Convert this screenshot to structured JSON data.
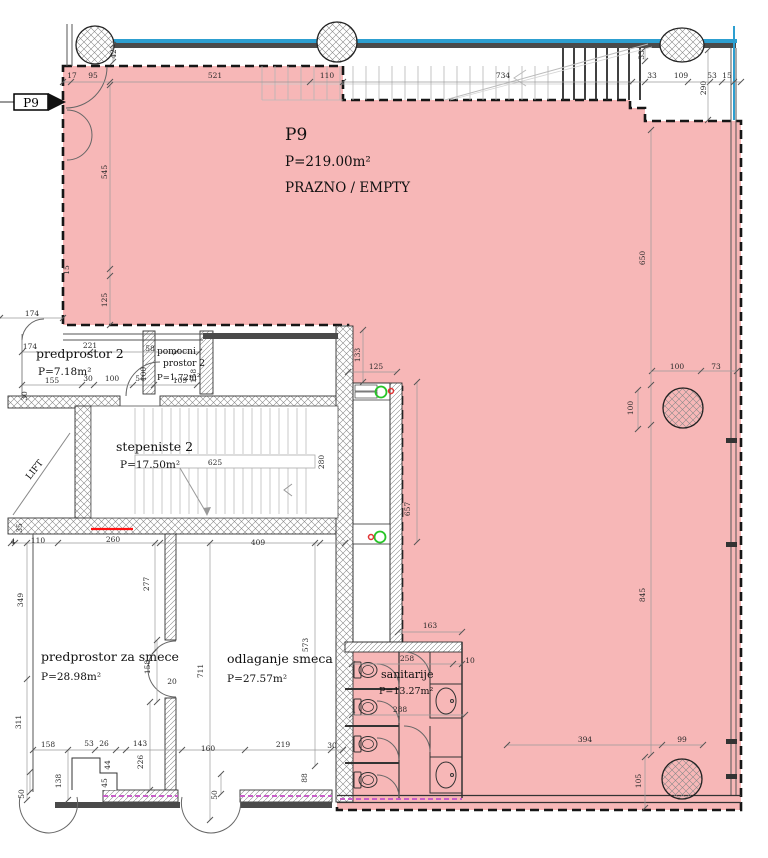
{
  "drawing": {
    "unit_tag": "P9",
    "main_space": {
      "name": "P9",
      "area": "P=219.00m²",
      "status": "PRAZNO / EMPTY"
    },
    "rooms": {
      "predprostor2": {
        "name": "predprostor 2",
        "area": "P=7.18m²"
      },
      "pomocni_prostor2": {
        "name_l1": "pomocni",
        "name_l2": "prostor 2",
        "area": "P=1.72m²"
      },
      "stepeniste2": {
        "name": "stepeniste 2",
        "area": "P=17.50m²"
      },
      "lift": {
        "name": "LIFT"
      },
      "predprostor_za_smece": {
        "name": "predprostor za smece",
        "area": "P=28.98m²"
      },
      "odlaganje_smeca": {
        "name": "odlaganje smeca",
        "area": "P=27.57m²"
      },
      "sanitarije": {
        "name": "sanitarije",
        "area": "P=13.27m²"
      }
    }
  },
  "colors": {
    "highlight_fill": "#ef6f6f",
    "highlight_border": "#161616",
    "accent_blue": "#2d9fd0",
    "wall_dark": "#4a4a4a",
    "insulation_magenta": "#c85fc8",
    "marker_green": "#27c427",
    "marker_red": "#e03232",
    "alert_red": "#ff1111"
  },
  "dims": [
    {
      "v": "17",
      "x": 72,
      "y": 78
    },
    {
      "v": "95",
      "x": 93,
      "y": 78
    },
    {
      "v": "521",
      "x": 215,
      "y": 78
    },
    {
      "v": "110",
      "x": 327,
      "y": 78
    },
    {
      "v": "734",
      "x": 503,
      "y": 78
    },
    {
      "v": "33",
      "x": 652,
      "y": 78
    },
    {
      "v": "109",
      "x": 681,
      "y": 78
    },
    {
      "v": "53",
      "x": 712,
      "y": 78
    },
    {
      "v": "15",
      "x": 727,
      "y": 78
    },
    {
      "v": "42",
      "x": 116,
      "y": 54,
      "r": true
    },
    {
      "v": "33",
      "x": 644,
      "y": 55,
      "r": true
    },
    {
      "v": "290",
      "x": 706,
      "y": 88,
      "r": true
    },
    {
      "v": "545",
      "x": 107,
      "y": 172,
      "r": true
    },
    {
      "v": "15",
      "x": 69,
      "y": 270,
      "r": true
    },
    {
      "v": "125",
      "x": 107,
      "y": 300,
      "r": true
    },
    {
      "v": "174",
      "x": 32,
      "y": 316
    },
    {
      "v": "174",
      "x": 30,
      "y": 349
    },
    {
      "v": "221",
      "x": 90,
      "y": 348
    },
    {
      "v": "58",
      "x": 150,
      "y": 351
    },
    {
      "v": "100",
      "x": 146,
      "y": 374,
      "r": true
    },
    {
      "v": "158",
      "x": 196,
      "y": 376,
      "r": true
    },
    {
      "v": "155",
      "x": 52,
      "y": 383
    },
    {
      "v": "30",
      "x": 88,
      "y": 381
    },
    {
      "v": "100",
      "x": 112,
      "y": 381
    },
    {
      "v": "54",
      "x": 140,
      "y": 381
    },
    {
      "v": "109",
      "x": 180,
      "y": 383
    },
    {
      "v": "30",
      "x": 27,
      "y": 396,
      "r": true
    },
    {
      "v": "133",
      "x": 360,
      "y": 355,
      "r": true
    },
    {
      "v": "125",
      "x": 376,
      "y": 369
    },
    {
      "v": "625",
      "x": 215,
      "y": 465
    },
    {
      "v": "280",
      "x": 324,
      "y": 462,
      "r": true
    },
    {
      "v": "35",
      "x": 22,
      "y": 528,
      "r": true
    },
    {
      "v": "4",
      "x": 13,
      "y": 544
    },
    {
      "v": "110",
      "x": 38,
      "y": 543
    },
    {
      "v": "260",
      "x": 113,
      "y": 542
    },
    {
      "v": "409",
      "x": 258,
      "y": 545
    },
    {
      "v": "657",
      "x": 410,
      "y": 509,
      "r": true
    },
    {
      "v": "650",
      "x": 645,
      "y": 258,
      "r": true
    },
    {
      "v": "845",
      "x": 645,
      "y": 595,
      "r": true
    },
    {
      "v": "100",
      "x": 677,
      "y": 369
    },
    {
      "v": "73",
      "x": 716,
      "y": 369
    },
    {
      "v": "100",
      "x": 633,
      "y": 408,
      "r": true
    },
    {
      "v": "277",
      "x": 149,
      "y": 584,
      "r": true
    },
    {
      "v": "349",
      "x": 23,
      "y": 600,
      "r": true
    },
    {
      "v": "311",
      "x": 21,
      "y": 722,
      "r": true
    },
    {
      "v": "158",
      "x": 150,
      "y": 667,
      "r": true
    },
    {
      "v": "20",
      "x": 172,
      "y": 684
    },
    {
      "v": "711",
      "x": 203,
      "y": 671,
      "r": true
    },
    {
      "v": "573",
      "x": 308,
      "y": 645,
      "r": true
    },
    {
      "v": "163",
      "x": 430,
      "y": 628
    },
    {
      "v": "258",
      "x": 407,
      "y": 661
    },
    {
      "v": "10",
      "x": 470,
      "y": 663
    },
    {
      "v": "288",
      "x": 400,
      "y": 712
    },
    {
      "v": "394",
      "x": 585,
      "y": 742
    },
    {
      "v": "99",
      "x": 682,
      "y": 742
    },
    {
      "v": "105",
      "x": 641,
      "y": 781,
      "r": true
    },
    {
      "v": "158",
      "x": 48,
      "y": 747
    },
    {
      "v": "53",
      "x": 89,
      "y": 746
    },
    {
      "v": "26",
      "x": 104,
      "y": 746
    },
    {
      "v": "143",
      "x": 140,
      "y": 746
    },
    {
      "v": "160",
      "x": 208,
      "y": 751
    },
    {
      "v": "219",
      "x": 283,
      "y": 747
    },
    {
      "v": "30",
      "x": 332,
      "y": 748
    },
    {
      "v": "50",
      "x": 24,
      "y": 794,
      "r": true
    },
    {
      "v": "138",
      "x": 61,
      "y": 781,
      "r": true
    },
    {
      "v": "44",
      "x": 110,
      "y": 765,
      "r": true
    },
    {
      "v": "45",
      "x": 107,
      "y": 783,
      "r": true
    },
    {
      "v": "226",
      "x": 143,
      "y": 762,
      "r": true
    },
    {
      "v": "88",
      "x": 307,
      "y": 778,
      "r": true
    },
    {
      "v": "50",
      "x": 217,
      "y": 795,
      "r": true
    }
  ]
}
